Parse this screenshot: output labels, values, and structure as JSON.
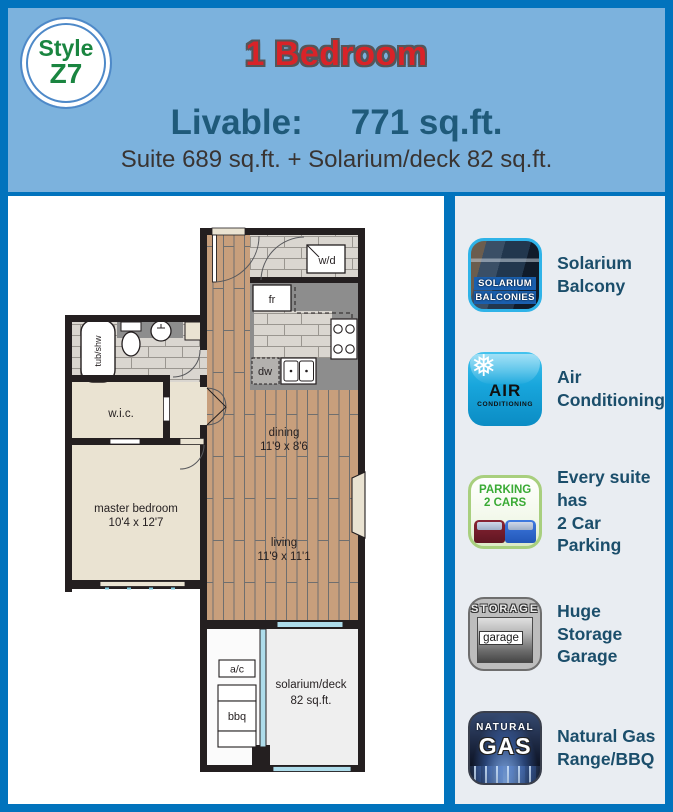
{
  "badge": {
    "line1": "Style",
    "line2": "Z7"
  },
  "header": {
    "title": "1 Bedroom",
    "livable_label": "Livable:",
    "livable_value": "771 sq.ft.",
    "subtitle": "Suite 689 sq.ft. + Solarium/deck 82 sq.ft."
  },
  "colors": {
    "border_blue": "#0173bd",
    "header_blue": "#7cb2dd",
    "title_red": "#d92328",
    "teal_text": "#1f5a7a",
    "label_teal": "#1b4e6b",
    "badge_green": "#1a8540",
    "wall_black": "#241f20",
    "wood_floor": "#c89f7c",
    "window_blue": "#aedcea"
  },
  "floorplan": {
    "labels": {
      "wd": "w/d",
      "fr": "fr",
      "dw": "dw",
      "tub_shw": "tub/shw",
      "wic": "w.i.c.",
      "master_line1": "master bedroom",
      "master_line2": "10'4 x 12'7",
      "dining_line1": "dining",
      "dining_line2": "11'9 x 8'6",
      "living_line1": "living",
      "living_line2": "11'9 x 11'1",
      "ac": "a/c",
      "bbq": "bbq",
      "solarium_line1": "solarium/deck",
      "solarium_line2": "82 sq.ft."
    }
  },
  "amenities": [
    {
      "icon_line1": "SOLARIUM",
      "icon_line2": "BALCONIES",
      "label_line1": "Solarium",
      "label_line2": "Balcony"
    },
    {
      "icon_line1": "AIR",
      "icon_line2": "CONDITIONING",
      "label_line1": "Air",
      "label_line2": "Conditioning"
    },
    {
      "icon_line1": "PARKING",
      "icon_line2": "2 CARS",
      "label_line1": "Every suite has",
      "label_line2": "2 Car Parking"
    },
    {
      "icon_line1": "STORAGE",
      "icon_line2": "garage",
      "label_line1": "Huge Storage",
      "label_line2": "Garage"
    },
    {
      "icon_line1": "NATURAL",
      "icon_line2": "GAS",
      "label_line1": "Natural Gas",
      "label_line2": "Range/BBQ"
    }
  ]
}
